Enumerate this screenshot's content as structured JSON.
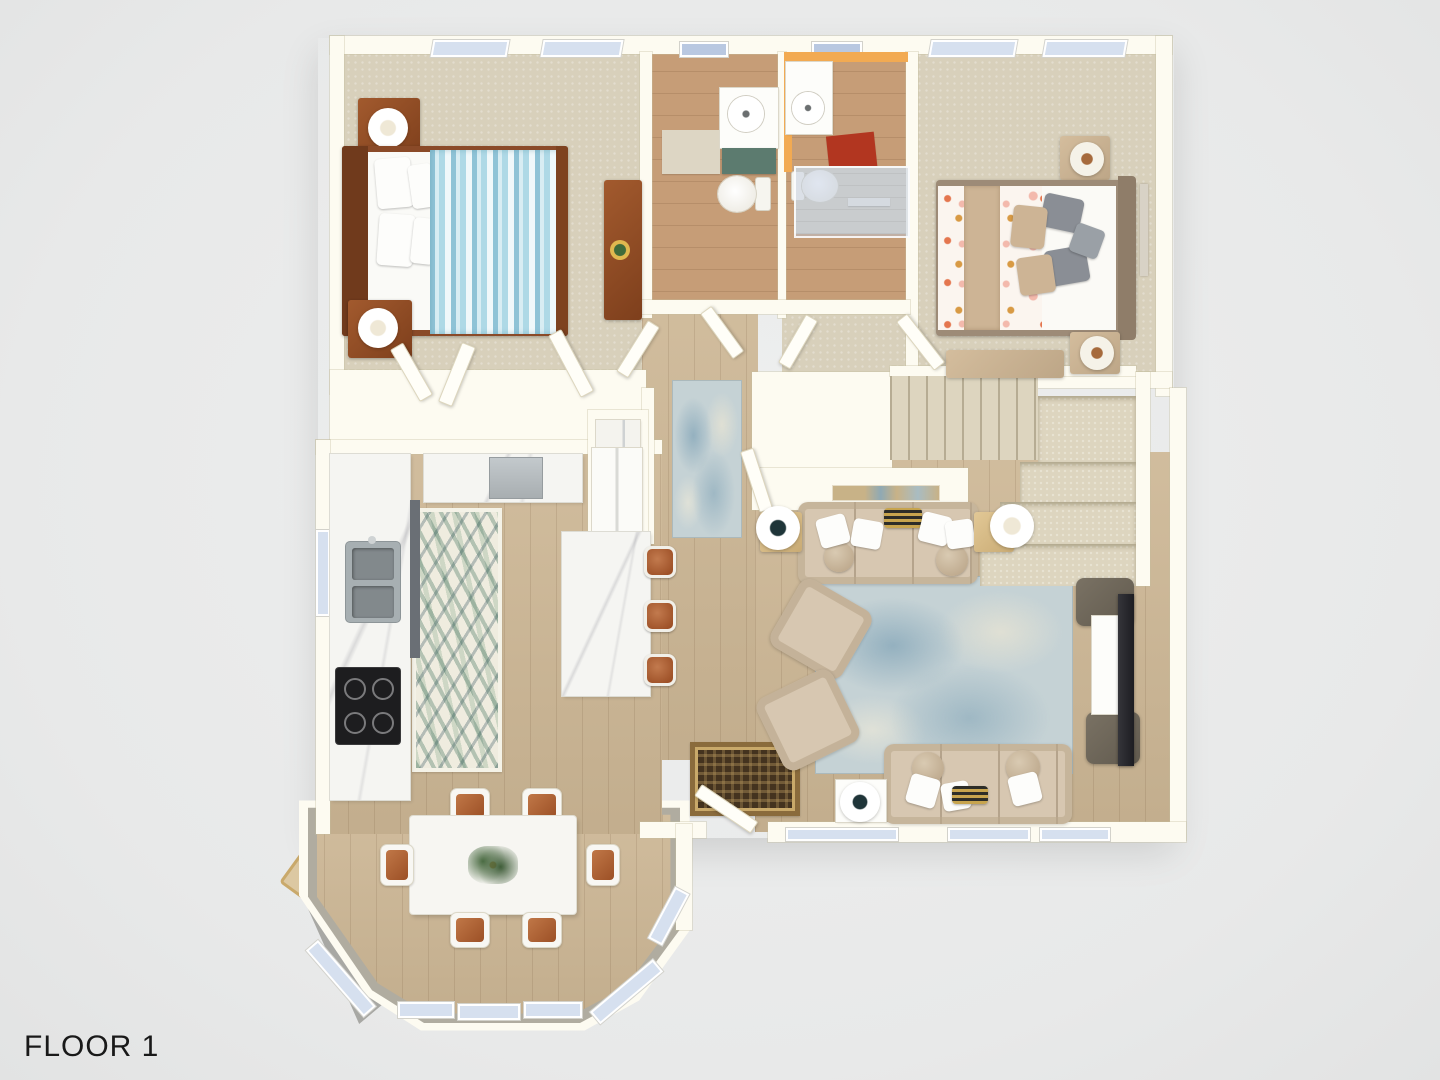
{
  "floor_label": "FLOOR 1",
  "palette": {
    "background": "#e8e9e9",
    "wall": "#fdfbf1",
    "carpet": "#d8d0bb",
    "wood_floor": "#cdb795",
    "bathroom_wood_floor": "#c69d77",
    "marble_counter": "#f5f5f2",
    "vanity_cabinet_teal": "#5c7b6f",
    "accent_wall_orange": "#f2aa52",
    "bath_mat_red": "#b23620",
    "bath_mat_beige": "#ddd6c4",
    "bed1_duvet_blue_stripe": "#8fc3d6",
    "bed1_wood_frame": "#8a4a28",
    "bed2_duvet_coral": "#e4764e",
    "bed2_headboard_taupe": "#9d8b77",
    "sofa_beige": "#d7c7b1",
    "area_rug_blue": "#c5d2d5",
    "runner_rug_blue": "#c5d2d5",
    "palm_rug_green": "#3e7361",
    "bar_stool_copper": "#ab5e3a",
    "stair_carpet": "#ddd5bf",
    "entry_rug_brown": "#44331f",
    "entry_rug_gold": "#c9a96a",
    "tv_dark": "#26262a",
    "ottoman_gray": "#6f6759",
    "window_glass": "#d6e0ef",
    "skylight_glass": "#b9c8e1",
    "porch_gray": "#a8a8a4",
    "label_text": "#191919"
  },
  "rooms": [
    {
      "id": "bedroom-1",
      "furniture": [
        "bed-blue-striped",
        "nightstand",
        "nightstand",
        "table-lamp",
        "table-lamp",
        "desk",
        "potted-plant",
        "closet-doors",
        "windows"
      ]
    },
    {
      "id": "bathroom-1",
      "furniture": [
        "vanity-sink",
        "teal-cabinet",
        "toilet",
        "bath-mat",
        "skylight"
      ]
    },
    {
      "id": "bathroom-2",
      "furniture": [
        "vanity-sink",
        "toilet",
        "glass-shower",
        "red-bath-mat",
        "towel-bar",
        "skylight"
      ]
    },
    {
      "id": "bedroom-2",
      "furniture": [
        "bed-coral-pattern",
        "nightstand",
        "nightstand",
        "table-lamp",
        "table-lamp",
        "foot-bench",
        "wall-art",
        "windows"
      ]
    },
    {
      "id": "hallway",
      "furniture": [
        "runner-rug",
        "laundry-closet",
        "washer",
        "interior-doors"
      ]
    },
    {
      "id": "staircase",
      "furniture": [
        "carpeted-upper-flight",
        "landing",
        "lower-steps"
      ]
    },
    {
      "id": "kitchen",
      "furniture": [
        "l-shaped-counter",
        "double-sink",
        "cooktop",
        "dishwasher",
        "refrigerator",
        "island",
        "bar-stool",
        "bar-stool",
        "bar-stool",
        "palm-runner-rug",
        "side-window"
      ]
    },
    {
      "id": "dining-room",
      "furniture": [
        "dining-table",
        "dining-chair-x6",
        "centerpiece",
        "bay-windows"
      ]
    },
    {
      "id": "living-room",
      "furniture": [
        "sofa",
        "sofa",
        "armchair",
        "armchair",
        "area-rug",
        "console-table",
        "side-table",
        "side-table",
        "side-table",
        "lamp",
        "lamp",
        "lamp",
        "tv",
        "media-console",
        "ottoman",
        "ottoman",
        "rear-windows"
      ]
    },
    {
      "id": "entry",
      "furniture": [
        "front-door",
        "oriental-rug"
      ]
    },
    {
      "id": "porch",
      "furniture": [
        "door-mat"
      ]
    }
  ]
}
